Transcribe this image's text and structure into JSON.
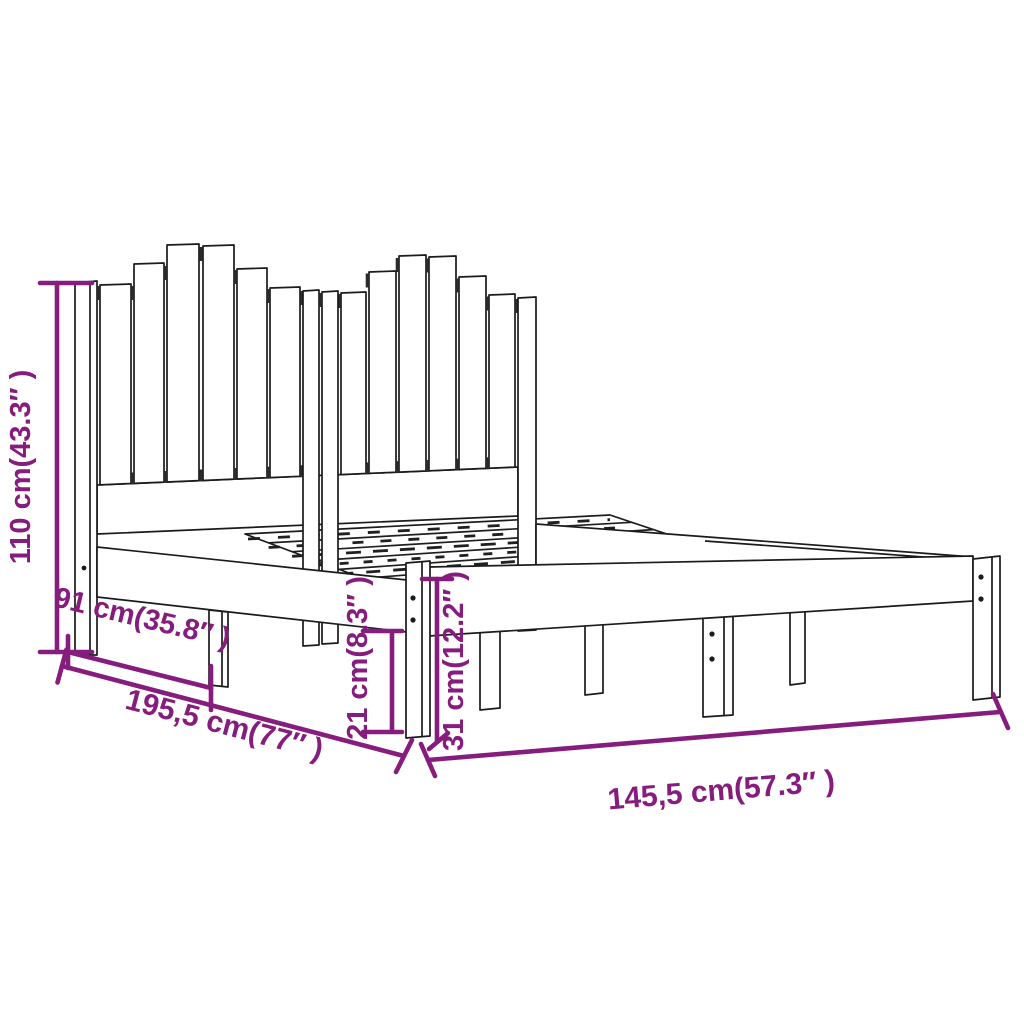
{
  "diagram": {
    "type": "product-dimension-diagram",
    "subject": "wooden bed frame with slatted headboard",
    "background_color": "#ffffff",
    "drawing_color": "#1b1b1b",
    "dimension_color": "#851c7e",
    "dimensions": {
      "headboard_height": {
        "label": "110 cm(43.3″ )",
        "cm": "110",
        "inches": "43.3"
      },
      "side_partial_depth": {
        "label": "91 cm(35.8″ )",
        "cm": "91",
        "inches": "35.8"
      },
      "frame_length": {
        "label": "195,5 cm(77″ )",
        "cm": "195,5",
        "inches": "77"
      },
      "under_bed_clearance": {
        "label": "21 cm(8.3″ )",
        "cm": "21",
        "inches": "8.3"
      },
      "frame_height": {
        "label": "31 cm(12.2″ )",
        "cm": "31",
        "inches": "12.2"
      },
      "frame_width": {
        "label": "145,5 cm(57.3″ )",
        "cm": "145,5",
        "inches": "57.3"
      }
    }
  }
}
